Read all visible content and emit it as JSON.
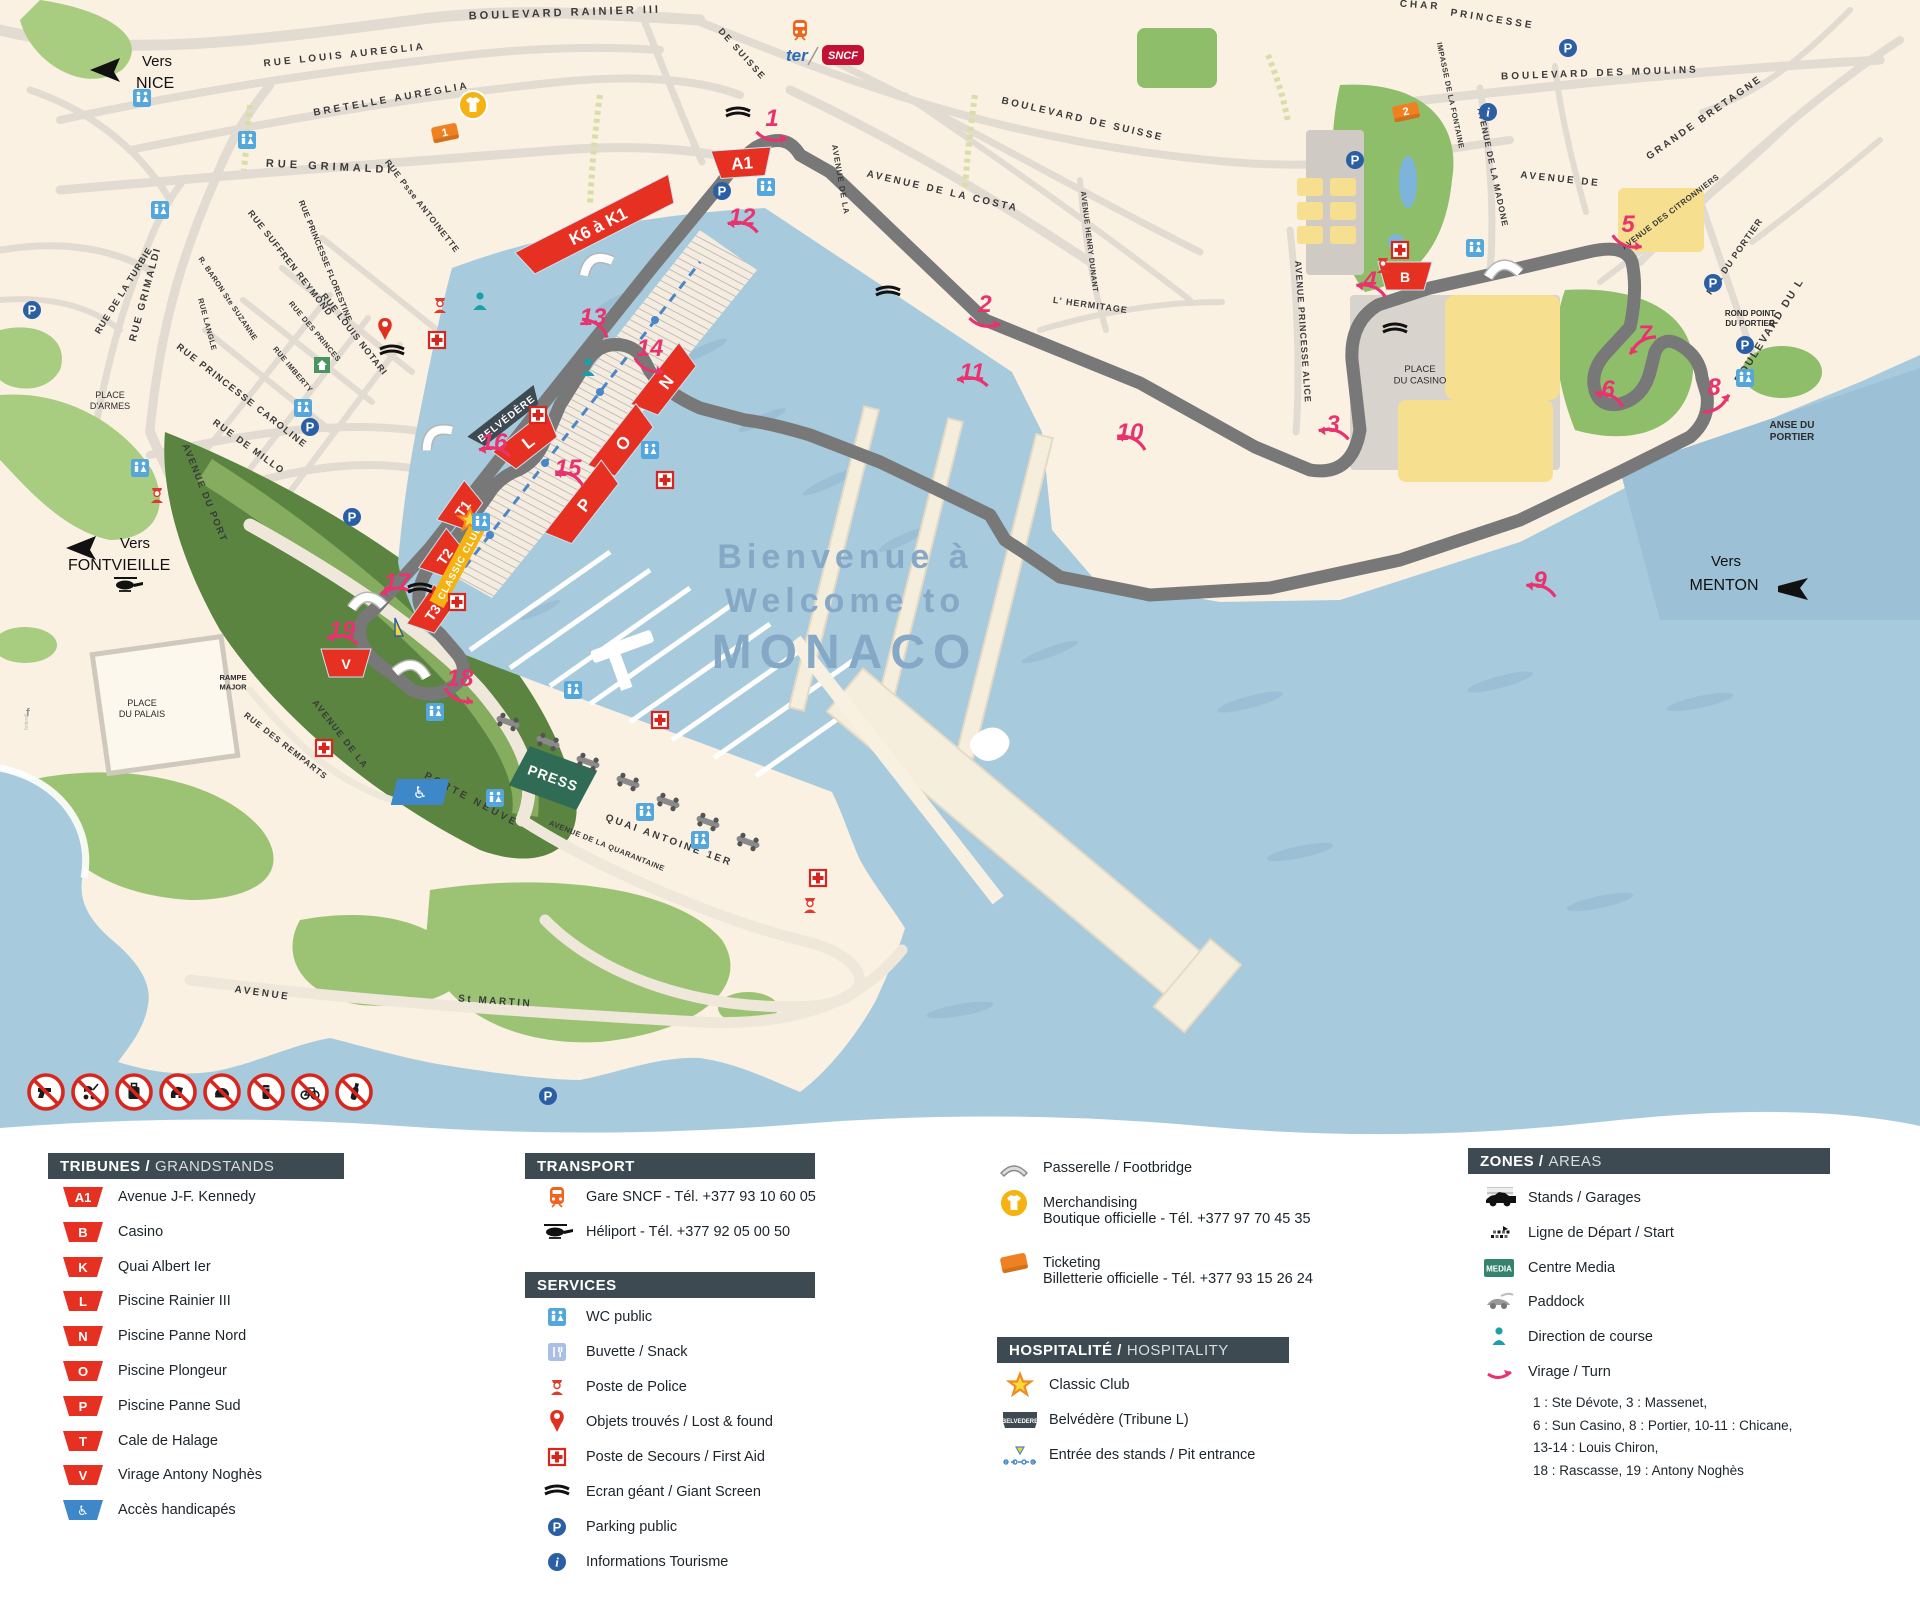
{
  "accent_colors": {
    "red": "#e63122",
    "pink": "#e8336e",
    "blue_icon": "#2b5fa5",
    "wc_blue": "#53a7dc",
    "teal": "#1aa0a8",
    "orange": "#f08122",
    "gold": "#f5b211",
    "slate": "#3d4a52",
    "sea": "#a8cadd",
    "media_green": "#35836f",
    "press_green": "#2f6b55"
  },
  "map": {
    "welcome": {
      "line1": "Bienvenue à",
      "line2": "Welcome to",
      "line3": "MONACO"
    },
    "directions": {
      "nice": {
        "word": "Vers",
        "name": "NICE"
      },
      "fontvieille": {
        "word": "Vers",
        "name": "FONTVIEILLE"
      },
      "menton": {
        "word": "Vers",
        "name": "MENTON"
      }
    },
    "logos": {
      "ter": "ter",
      "sncf": "SNCF"
    },
    "streets": [
      {
        "t": "BOULEVARD RAINIER III",
        "x": 565,
        "y": 16,
        "r": -2,
        "s": 11,
        "ls": 3
      },
      {
        "t": "RUE LOUIS AUREGLIA",
        "x": 345,
        "y": 58,
        "r": -6,
        "s": 10,
        "ls": 3
      },
      {
        "t": "BRETELLE AUREGLIA",
        "x": 392,
        "y": 102,
        "r": -10,
        "s": 10,
        "ls": 3
      },
      {
        "t": "RUE GRIMALDI",
        "x": 330,
        "y": 170,
        "r": 3,
        "s": 11,
        "ls": 4
      },
      {
        "t": "RUE GRIMALDI",
        "x": 148,
        "y": 295,
        "r": -75,
        "s": 10,
        "ls": 2
      },
      {
        "t": "RUE DE LA TURBIE",
        "x": 126,
        "y": 292,
        "r": -58,
        "s": 9,
        "ls": 1
      },
      {
        "t": "RUE Psse ANTOINETTE",
        "x": 420,
        "y": 208,
        "r": 52,
        "s": 8.5,
        "ls": 1
      },
      {
        "t": "RUE SUFFREN REYMOND",
        "x": 288,
        "y": 265,
        "r": 52,
        "s": 9,
        "ls": 1
      },
      {
        "t": "RUE PRINCESSE FLORESTINE",
        "x": 323,
        "y": 262,
        "r": 68,
        "s": 8,
        "ls": 0.5
      },
      {
        "t": "R. BARON Ste SUZANNE",
        "x": 226,
        "y": 300,
        "r": 56,
        "s": 7.5,
        "ls": 0.5
      },
      {
        "t": "RUE LANGLE",
        "x": 205,
        "y": 325,
        "r": 75,
        "s": 7.5,
        "ls": 0.5
      },
      {
        "t": "RUE DES PRINCES",
        "x": 313,
        "y": 333,
        "r": 50,
        "s": 7.5,
        "ls": 0.5
      },
      {
        "t": "RUE IMBERTY",
        "x": 291,
        "y": 371,
        "r": 50,
        "s": 7.5,
        "ls": 0.5
      },
      {
        "t": "RUE LOUIS NOTARI",
        "x": 352,
        "y": 336,
        "r": 52,
        "s": 9,
        "ls": 1
      },
      {
        "t": "RUE PRINCESSE CAROLINE",
        "x": 240,
        "y": 398,
        "r": 38,
        "s": 9.5,
        "ls": 1.5
      },
      {
        "t": "RUE DE MILLO",
        "x": 247,
        "y": 449,
        "r": 36,
        "s": 9.5,
        "ls": 1.5
      },
      {
        "t": "AVENUE DU PORT",
        "x": 202,
        "y": 494,
        "r": 68,
        "s": 9.5,
        "ls": 1.5
      },
      {
        "t": "AVENUE DE LA COSTA",
        "x": 942,
        "y": 194,
        "r": 13,
        "s": 10,
        "ls": 2.5
      },
      {
        "t": "AVENUE DE LA",
        "x": 838,
        "y": 180,
        "r": 80,
        "s": 8,
        "ls": 1
      },
      {
        "t": "BOULEVARD DE SUISSE",
        "x": 1082,
        "y": 122,
        "r": 13,
        "s": 10,
        "ls": 2.5
      },
      {
        "t": "DE SUISSE",
        "x": 740,
        "y": 56,
        "r": 48,
        "s": 9,
        "ls": 2
      },
      {
        "t": "IMPASSE DE LA FONTAINE",
        "x": 1448,
        "y": 96,
        "r": 78,
        "s": 7.5,
        "ls": 0.5
      },
      {
        "t": "BOULEVARD DES MOULINS",
        "x": 1600,
        "y": 76,
        "r": -2,
        "s": 10,
        "ls": 3
      },
      {
        "t": "AVENUE DE LA MADONE",
        "x": 1490,
        "y": 168,
        "r": 78,
        "s": 8.5,
        "ls": 1
      },
      {
        "t": "AVENUE DE",
        "x": 1560,
        "y": 182,
        "r": 6,
        "s": 10,
        "ls": 2.5
      },
      {
        "t": "GRANDE BRETAGNE",
        "x": 1706,
        "y": 120,
        "r": -35,
        "s": 10,
        "ls": 2.5
      },
      {
        "t": "AVENUE DES CITRONNIERS",
        "x": 1672,
        "y": 214,
        "r": -37,
        "s": 8,
        "ls": 0.5
      },
      {
        "t": "AVENUE HENRY DUNANT",
        "x": 1087,
        "y": 242,
        "r": 83,
        "s": 7.5,
        "ls": 0.5
      },
      {
        "t": "L' HERMITAGE",
        "x": 1090,
        "y": 308,
        "r": 8,
        "s": 9,
        "ls": 1
      },
      {
        "t": "AVENUE PRINCESSE ALICE",
        "x": 1300,
        "y": 332,
        "r": 86,
        "s": 9,
        "ls": 1
      },
      {
        "t": "RUE DU PORTIER",
        "x": 1737,
        "y": 258,
        "r": -55,
        "s": 9,
        "ls": 1
      },
      {
        "t": "BOULEVARD DU L",
        "x": 1772,
        "y": 332,
        "r": -58,
        "s": 10.5,
        "ls": 2
      },
      {
        "t": "PRINCESSE",
        "x": 1492,
        "y": 22,
        "r": 9,
        "s": 10,
        "ls": 3
      },
      {
        "t": "CHAR",
        "x": 1420,
        "y": 8,
        "r": 4,
        "s": 10,
        "ls": 3
      },
      {
        "t": "QUAI ANTOINE 1ER",
        "x": 668,
        "y": 843,
        "r": 20,
        "s": 10,
        "ls": 2.5
      },
      {
        "t": "AVENUE DE LA QUARANTAINE",
        "x": 606,
        "y": 848,
        "r": 22,
        "s": 7.5,
        "ls": 0.5
      },
      {
        "t": "AVENUE",
        "x": 262,
        "y": 996,
        "r": 8,
        "s": 10,
        "ls": 2.5
      },
      {
        "t": "St MARTIN",
        "x": 495,
        "y": 1004,
        "r": 4,
        "s": 10,
        "ls": 2.5
      },
      {
        "t": "RUE DES REMPARTS",
        "x": 284,
        "y": 748,
        "r": 38,
        "s": 8.5,
        "ls": 1
      },
      {
        "t": "AVENUE DE LA",
        "x": 338,
        "y": 736,
        "r": 52,
        "s": 9,
        "ls": 1.5
      },
      {
        "t": "PORTE NEUVE",
        "x": 470,
        "y": 802,
        "r": 28,
        "s": 10,
        "ls": 3
      }
    ],
    "places": [
      {
        "l1": "PLACE",
        "l2": "D'ARMES",
        "x": 110,
        "y": 398,
        "s": 9
      },
      {
        "l1": "PLACE",
        "l2": "DU PALAIS",
        "x": 142,
        "y": 706,
        "s": 9
      },
      {
        "l1": "PLACE",
        "l2": "DU CASINO",
        "x": 1420,
        "y": 372,
        "s": 9.5
      },
      {
        "l1": "ANSE DU",
        "l2": "PORTIER",
        "x": 1792,
        "y": 428,
        "s": 10,
        "b": 1
      },
      {
        "l1": "ROND POINT",
        "l2": "DU PORTIER",
        "x": 1750,
        "y": 316,
        "s": 8,
        "b": 1
      },
      {
        "l1": "RAMPE",
        "l2": "MAJOR",
        "x": 233,
        "y": 680,
        "s": 7.5,
        "b": 1
      }
    ],
    "turns": [
      {
        "n": "1",
        "x": 772,
        "y": 126,
        "r": 15
      },
      {
        "n": "2",
        "x": 985,
        "y": 312,
        "r": 15
      },
      {
        "n": "3",
        "x": 1333,
        "y": 432,
        "r": 200
      },
      {
        "n": "4",
        "x": 1370,
        "y": 288,
        "r": 205
      },
      {
        "n": "5",
        "x": 1628,
        "y": 232,
        "r": 25
      },
      {
        "n": "6",
        "x": 1608,
        "y": 397,
        "r": 210
      },
      {
        "n": "7",
        "x": 1645,
        "y": 342,
        "r": 150
      },
      {
        "n": "8",
        "x": 1714,
        "y": 395,
        "r": 330
      },
      {
        "n": "9",
        "x": 1540,
        "y": 588,
        "r": 205
      },
      {
        "n": "10",
        "x": 1130,
        "y": 440,
        "r": 210
      },
      {
        "n": "11",
        "x": 972,
        "y": 380,
        "r": 195
      },
      {
        "n": "12",
        "x": 742,
        "y": 225,
        "r": 200
      },
      {
        "n": "13",
        "x": 593,
        "y": 325,
        "r": 220
      },
      {
        "n": "14",
        "x": 650,
        "y": 356,
        "r": 30
      },
      {
        "n": "15",
        "x": 568,
        "y": 476,
        "r": 210
      },
      {
        "n": "16",
        "x": 494,
        "y": 450,
        "r": 195
      },
      {
        "n": "17",
        "x": 397,
        "y": 590,
        "r": 180
      },
      {
        "n": "18",
        "x": 460,
        "y": 686,
        "r": 30
      },
      {
        "n": "19",
        "x": 342,
        "y": 638,
        "r": 195
      }
    ],
    "grandstands": [
      {
        "label": "A1",
        "x": 742,
        "y": 163,
        "r": -4,
        "w": 46
      },
      {
        "label": "K6 à K1",
        "x": 598,
        "y": 226,
        "r": -27,
        "w": 158
      },
      {
        "label": "B",
        "x": 1405,
        "y": 276,
        "r": 0,
        "w": 40
      },
      {
        "label": "L",
        "x": 528,
        "y": 442,
        "r": -38,
        "w": 54
      },
      {
        "label": "N",
        "x": 666,
        "y": 382,
        "r": -52,
        "w": 64
      },
      {
        "label": "O",
        "x": 623,
        "y": 443,
        "r": -52,
        "w": 64
      },
      {
        "label": "P",
        "x": 584,
        "y": 505,
        "r": -52,
        "w": 78
      },
      {
        "label": "T1",
        "x": 462,
        "y": 508,
        "r": -55,
        "w": 34
      },
      {
        "label": "T2",
        "x": 444,
        "y": 556,
        "r": -55,
        "w": 34
      },
      {
        "label": "T3",
        "x": 432,
        "y": 612,
        "r": -55,
        "w": 34
      },
      {
        "label": "V",
        "x": 346,
        "y": 663,
        "r": 0,
        "w": 36
      }
    ],
    "badges": {
      "belvedere": {
        "t": "BELVÉDÈRE",
        "x": 506,
        "y": 418,
        "r": -38
      },
      "classic_club": {
        "t": "CLASSIC CLUB",
        "x": 459,
        "y": 562,
        "r": -62
      },
      "press": {
        "t": "PRESS",
        "x": 553,
        "y": 778,
        "r": 20
      }
    },
    "markers": [
      {
        "type": "ticket",
        "num": "1",
        "x": 445,
        "y": 133
      },
      {
        "type": "ticket",
        "num": "2",
        "x": 1406,
        "y": 112
      }
    ],
    "icons": {
      "wc": [
        [
          142,
          98
        ],
        [
          160,
          210
        ],
        [
          247,
          140
        ],
        [
          303,
          408
        ],
        [
          140,
          468
        ],
        [
          766,
          187
        ],
        [
          650,
          450
        ],
        [
          481,
          522
        ],
        [
          435,
          712
        ],
        [
          495,
          798
        ],
        [
          645,
          812
        ],
        [
          700,
          840
        ],
        [
          1475,
          248
        ],
        [
          1745,
          378
        ],
        [
          573,
          690
        ]
      ],
      "aid": [
        [
          437,
          340
        ],
        [
          538,
          415
        ],
        [
          665,
          480
        ],
        [
          324,
          748
        ],
        [
          818,
          878
        ],
        [
          1400,
          250
        ],
        [
          457,
          602
        ],
        [
          660,
          720
        ]
      ],
      "park": [
        [
          32,
          310
        ],
        [
          310,
          427
        ],
        [
          722,
          191
        ],
        [
          1355,
          160
        ],
        [
          1568,
          48
        ],
        [
          1713,
          283
        ],
        [
          1745,
          345
        ],
        [
          352,
          517
        ],
        [
          548,
          1096
        ]
      ],
      "info": [
        [
          1488,
          112
        ]
      ],
      "police": [
        [
          440,
          305
        ],
        [
          1383,
          265
        ],
        [
          157,
          495
        ],
        [
          810,
          905
        ]
      ],
      "heli": [
        [
          127,
          585
        ]
      ],
      "train": [
        [
          800,
          30
        ]
      ],
      "merch": [
        [
          473,
          105
        ]
      ],
      "pin": [
        [
          385,
          330
        ]
      ],
      "house": [
        [
          322,
          365
        ]
      ],
      "person": [
        [
          588,
          368
        ],
        [
          480,
          302
        ]
      ],
      "screen": [
        [
          738,
          114
        ],
        [
          888,
          293
        ],
        [
          1395,
          330
        ],
        [
          392,
          352
        ],
        [
          420,
          590
        ]
      ],
      "bridge": [
        [
          595,
          262,
          -27
        ],
        [
          435,
          435,
          -38
        ],
        [
          367,
          600,
          -5
        ],
        [
          412,
          668,
          10
        ],
        [
          1503,
          268,
          -8
        ]
      ],
      "car": [
        [
          508,
          722
        ],
        [
          548,
          742
        ],
        [
          588,
          762
        ],
        [
          628,
          782
        ],
        [
          668,
          802
        ],
        [
          708,
          822
        ],
        [
          748,
          842
        ]
      ],
      "handicap": [
        [
          420,
          792
        ]
      ],
      "sail": [
        [
          395,
          628
        ]
      ]
    },
    "watermark": "federall"
  },
  "prohibitions": [
    {
      "name": "no-firearms"
    },
    {
      "name": "no-strollers"
    },
    {
      "name": "no-luggage"
    },
    {
      "name": "no-dogs"
    },
    {
      "name": "no-helmets"
    },
    {
      "name": "no-cans"
    },
    {
      "name": "no-bicycles"
    },
    {
      "name": "no-bottles"
    }
  ],
  "legend": {
    "tribunes": {
      "title": "TRIBUNES /",
      "title2": "GRANDSTANDS",
      "items": [
        {
          "code": "A1",
          "label": "Avenue J-F. Kennedy",
          "color": "red"
        },
        {
          "code": "B",
          "label": "Casino",
          "color": "red"
        },
        {
          "code": "K",
          "label": "Quai Albert Ier",
          "color": "red"
        },
        {
          "code": "L",
          "label": "Piscine Rainier III",
          "color": "red"
        },
        {
          "code": "N",
          "label": "Piscine Panne Nord",
          "color": "red"
        },
        {
          "code": "O",
          "label": "Piscine Plongeur",
          "color": "red"
        },
        {
          "code": "P",
          "label": "Piscine Panne Sud",
          "color": "red"
        },
        {
          "code": "T",
          "label": "Cale de Halage",
          "color": "red"
        },
        {
          "code": "V",
          "label": "Virage Antony Noghès",
          "color": "red"
        },
        {
          "code": "♿",
          "label": "Accès handicapés",
          "color": "blue"
        }
      ]
    },
    "transport": {
      "title": "TRANSPORT",
      "items": [
        {
          "icon": "train",
          "label": "Gare SNCF - Tél. +377 93 10 60 05"
        },
        {
          "icon": "heli",
          "label": "Héliport - Tél. +377 92 05 00 50"
        }
      ]
    },
    "services": {
      "title": "SERVICES",
      "items": [
        {
          "icon": "wc",
          "label": "WC public"
        },
        {
          "icon": "buvette",
          "label": "Buvette / Snack"
        },
        {
          "icon": "police",
          "label": "Poste de Police"
        },
        {
          "icon": "pin",
          "label": "Objets trouvés / Lost & found"
        },
        {
          "icon": "aid",
          "label": "Poste de Secours / First Aid"
        },
        {
          "icon": "screen",
          "label": "Ecran géant / Giant Screen"
        },
        {
          "icon": "park",
          "label": "Parking public"
        },
        {
          "icon": "info",
          "label": "Informations Tourisme"
        }
      ]
    },
    "column3": {
      "items": [
        {
          "icon": "bridgeleg",
          "label": "Passerelle / Footbridge",
          "sub": ""
        },
        {
          "icon": "merch",
          "label": "Merchandising",
          "sub": "Boutique officielle - Tél. +377 97 70 45 35"
        },
        {
          "icon": "ticket",
          "label": "Ticketing",
          "sub": "Billetterie officielle - Tél. +377 93 15 26 24"
        }
      ]
    },
    "hospitality": {
      "title": "HOSPITALITÉ /",
      "title2": "HOSPITALITY",
      "items": [
        {
          "icon": "star",
          "label": "Classic Club"
        },
        {
          "icon": "belvedere",
          "label": "Belvédère (Tribune L)"
        },
        {
          "icon": "pit",
          "label": "Entrée des stands / Pit entrance"
        }
      ]
    },
    "zones": {
      "title": "ZONES /",
      "title2": "AREAS",
      "items": [
        {
          "icon": "f1car",
          "label": "Stands / Garages"
        },
        {
          "icon": "startline",
          "label": "Ligne de Départ / Start"
        },
        {
          "icon": "media",
          "label": "Centre Media"
        },
        {
          "icon": "paddock",
          "label": "Paddock"
        },
        {
          "icon": "person",
          "label": "Direction de course"
        },
        {
          "icon": "turn",
          "label": "Virage / Turn"
        }
      ],
      "turn_notes": [
        "1 : Ste Dévote, 3 : Massenet,",
        "6 : Sun Casino, 8 : Portier, 10-11 : Chicane,",
        "13-14 : Louis Chiron,",
        "18 : Rascasse, 19 : Antony Noghès"
      ],
      "media_badge": "MEDIA",
      "belvedere_badge": "BELVEDERE"
    }
  }
}
